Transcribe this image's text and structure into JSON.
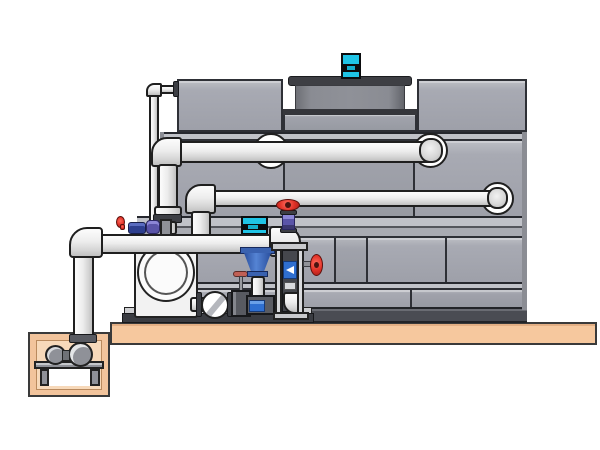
{
  "scene": {
    "kind": "technical-illustration",
    "subject": "closed-circuit cooling tower with pump skid and sump",
    "background": "#ffffff",
    "no_visible_text": true
  },
  "components": {
    "tower": "cooling-tower-body",
    "fan_cowl": "fan-cowl",
    "fan_motor": "fan-motor",
    "upper_pipe": "upper-supply-pipe",
    "middle_pipe": "middle-return-pipe",
    "makeup_line": "thin-makeup-water-line",
    "header": "pump-suction-header",
    "sump_pit": "concrete-sump-pit",
    "sump_pump": "sump-pump",
    "volute_pump": "end-suction-pump",
    "vertical_pump": "vertical-inline-pump",
    "instrument_stand": "drop-pipe-stand",
    "discharge_valve": "red-handwheel-valve",
    "side_valve": "basin-side-handwheel-valve",
    "check_valve": "wafer-check-valve",
    "gate_valve": "gate-valve",
    "skid_base": "pump-skid-base",
    "ground_slab": "concrete-ground-slab"
  },
  "palette": {
    "panel_gray": "#a8aab3",
    "panel_outline": "#2e3036",
    "rail_gray": "#c0c2c8",
    "basin_dark": "#4a4c53",
    "cowl_gray": "#85878e",
    "cowl_rim_dark": "#3e3f44",
    "motor_cyan": "#1fc4e6",
    "pipe_white": "#ededed",
    "flange_dark": "#3c3e44",
    "ground_tan": "#f6c89e",
    "pit_tan": "#f2c49c",
    "pit_inner_tan": "#f7d9ba",
    "valve_red": "#e03127",
    "valve_purple": "#5a54a8",
    "fitting_dark_blue": "#2e3f8f",
    "display_blue": "#2f6fd0",
    "funnel_blue": "#3a62b0",
    "stand_gray": "#d8d9dc"
  }
}
